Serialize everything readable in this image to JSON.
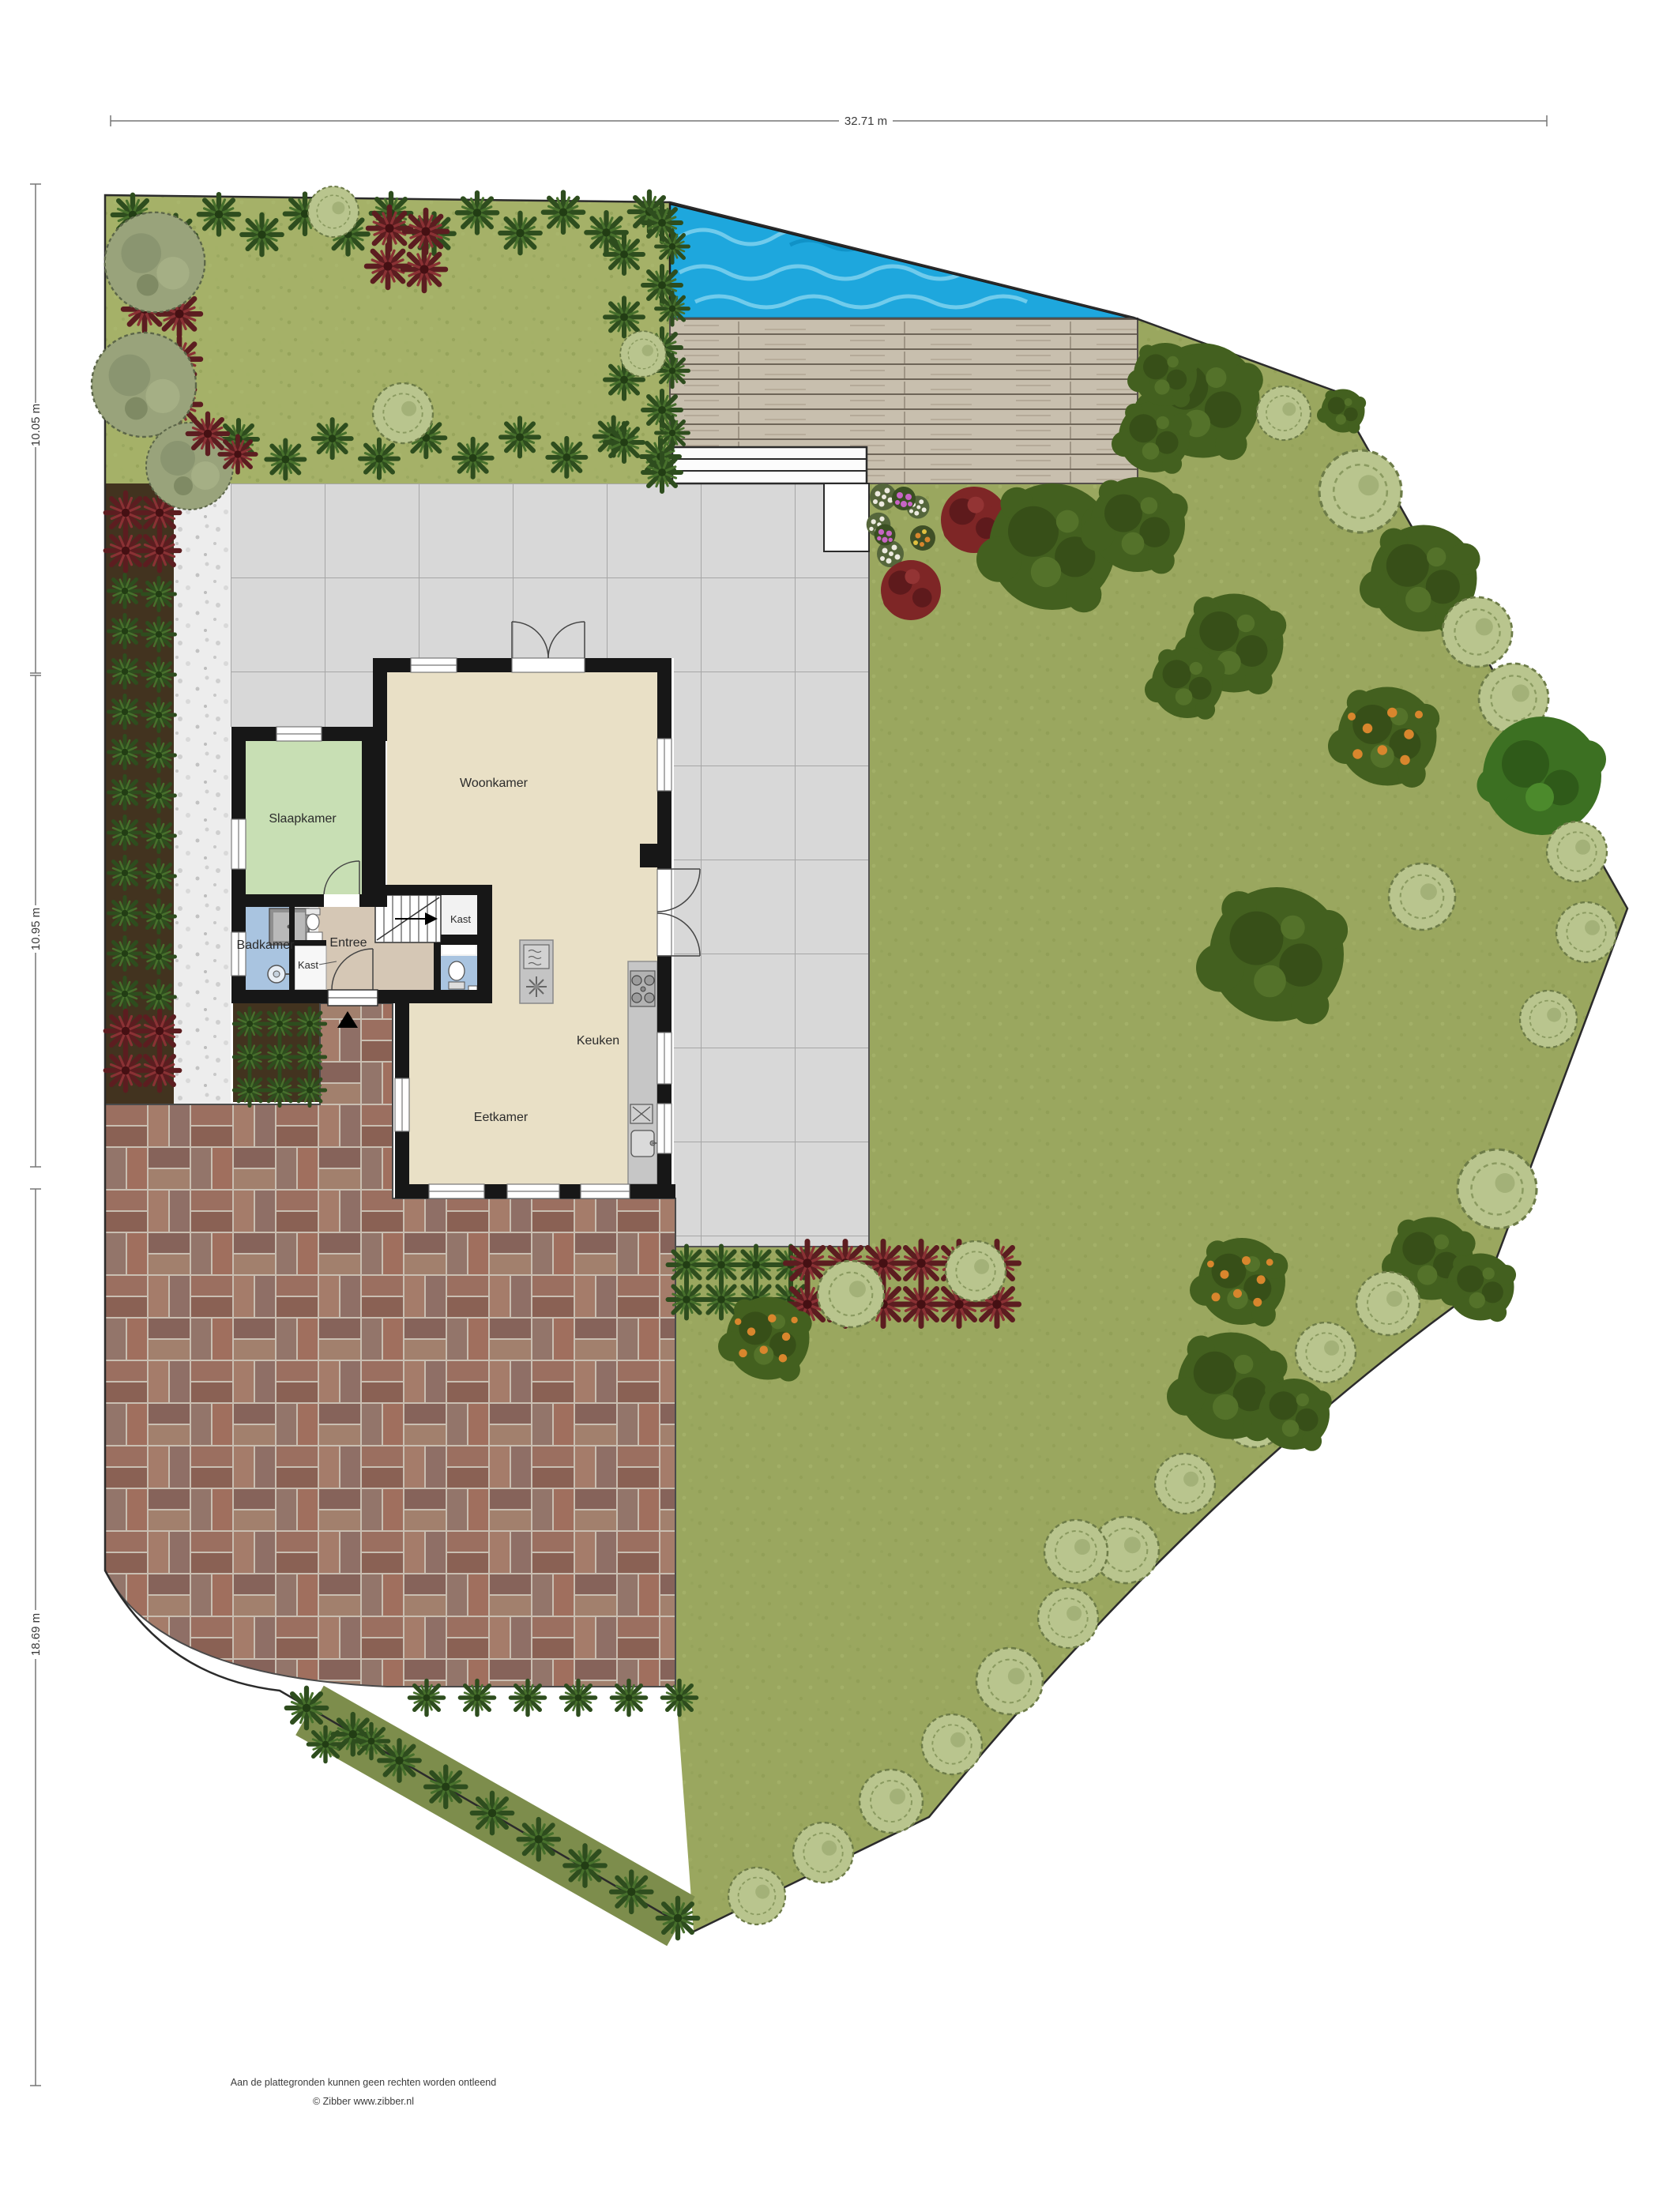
{
  "dimensions": {
    "total_width": "32.71 m",
    "section_top": "10.05 m",
    "section_middle": "10.95 m",
    "section_bottom": "18.69 m"
  },
  "rooms": {
    "woonkamer": "Woonkamer",
    "slaapkamer": "Slaapkamer",
    "badkamer": "Badkamer",
    "entree": "Entree",
    "kast_badkamer": "Kast",
    "kast_hal": "Kast",
    "keuken": "Keuken",
    "eetkamer": "Eetkamer"
  },
  "footer": {
    "disclaimer": "Aan de plattegronden kunnen geen rechten worden ontleend",
    "copyright": "© Zibber www.zibber.nl"
  },
  "colors": {
    "pool_water": "#1ea7dd",
    "lawn": "#9aa75f",
    "front_garden": "#a5b168",
    "deck_wood": "#c8bfae",
    "terrace_tile": "#d8d8d8",
    "brick_base": "#9b6f60",
    "wall": "#171717",
    "woonkamer_floor": "#e9e0c6",
    "slaapkamer_floor": "#c8dfb4",
    "badkamer_floor": "#a9c4e0",
    "entree_floor": "#d5c7b5"
  },
  "features": {
    "pool": "swimming-pool",
    "deck": "wood-deck",
    "terrace": "tile-terrace",
    "driveway": "brick-driveway",
    "gravel": "gravel-path",
    "entrance_marker": "entrance-arrow-icon"
  }
}
